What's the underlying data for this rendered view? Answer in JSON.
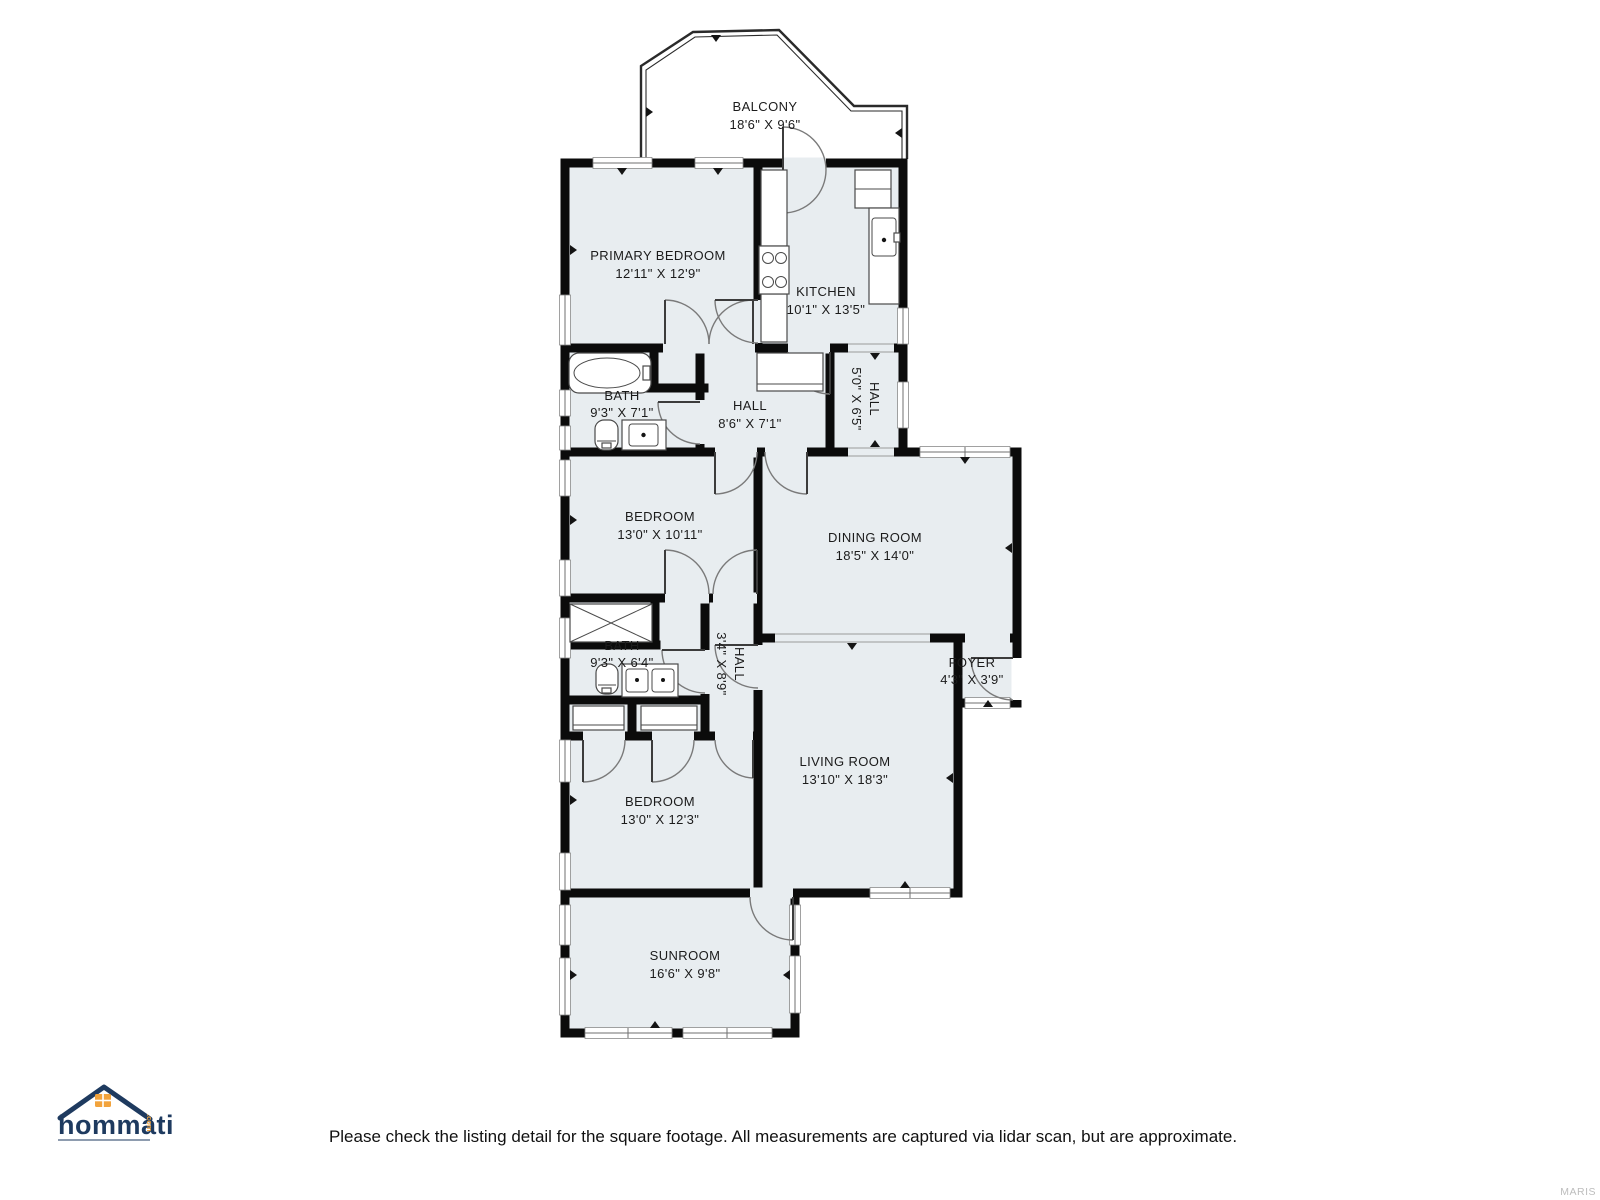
{
  "title": "Floor plan",
  "rooms": [
    {
      "id": "balcony",
      "name": "BALCONY",
      "dims": "18'6\" X 9'6\""
    },
    {
      "id": "primary-bedroom",
      "name": "PRIMARY BEDROOM",
      "dims": "12'11\" X 12'9\""
    },
    {
      "id": "kitchen",
      "name": "KITCHEN",
      "dims": "10'1\" X 13'5\""
    },
    {
      "id": "bath-upper",
      "name": "BATH",
      "dims": "9'3\" X 7'1\""
    },
    {
      "id": "hall-upper",
      "name": "HALL",
      "dims": "8'6\" X 7'1\""
    },
    {
      "id": "hall-side",
      "name": "HALL",
      "dims": "5'0\" X 6'5\""
    },
    {
      "id": "bedroom-middle",
      "name": "BEDROOM",
      "dims": "13'0\" X 10'11\""
    },
    {
      "id": "dining-room",
      "name": "DINING ROOM",
      "dims": "18'5\" X 14'0\""
    },
    {
      "id": "bath-lower",
      "name": "BATH",
      "dims": "9'3\" X 6'4\""
    },
    {
      "id": "hall-lower",
      "name": "HALL",
      "dims": "3'4\" X 8'9\""
    },
    {
      "id": "foyer",
      "name": "FOYER",
      "dims": "4'3\" X 3'9\""
    },
    {
      "id": "living-room",
      "name": "LIVING ROOM",
      "dims": "13'10\" X 18'3\""
    },
    {
      "id": "bedroom-lower",
      "name": "BEDROOM",
      "dims": "13'0\" X 12'3\""
    },
    {
      "id": "sunroom",
      "name": "SUNROOM",
      "dims": "16'6\" X 9'8\""
    }
  ],
  "footer": {
    "disclaimer": "Please check the listing detail for the square footage. All measurements are captured via lidar scan, but are approximate.",
    "watermark": "MARIS"
  },
  "logo": {
    "brand": "hommati",
    "tld": ".com"
  },
  "colors": {
    "room_fill": "#e8edf0",
    "wall": "#0b0b0b",
    "brand_navy": "#1e3a5f",
    "brand_orange": "#f2a33c"
  }
}
